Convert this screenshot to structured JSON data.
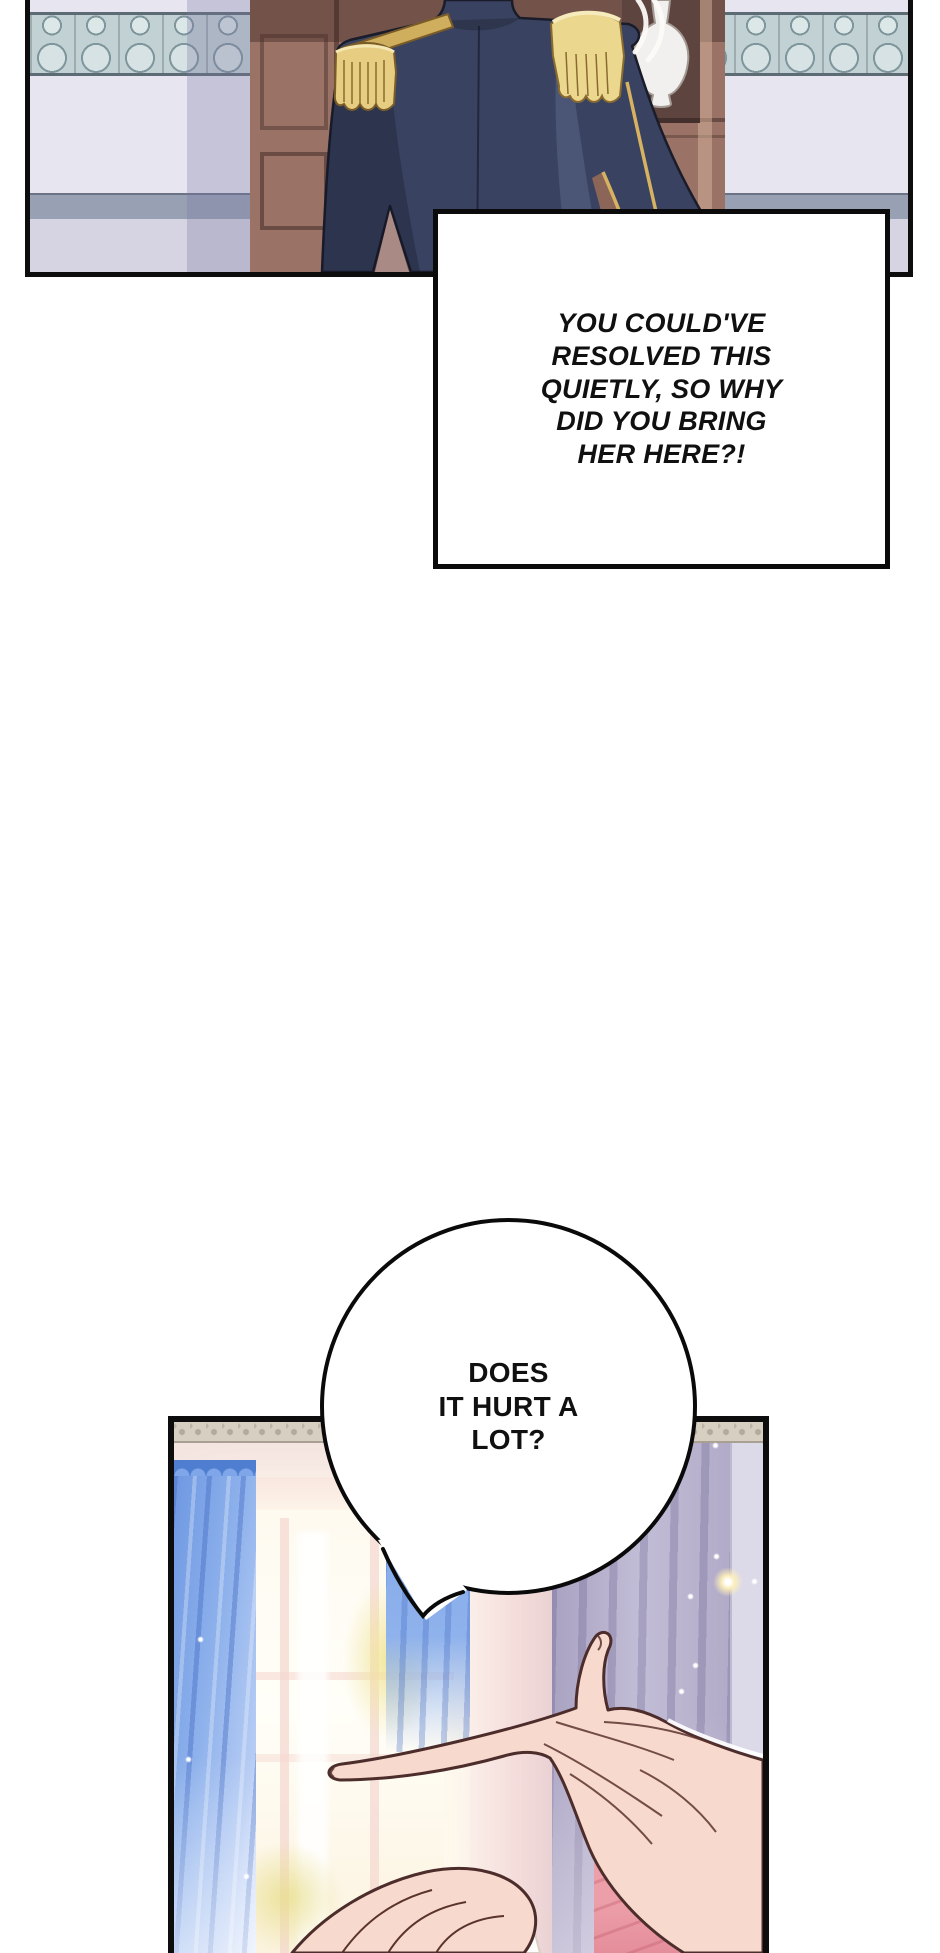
{
  "meta": {
    "kind": "webtoon comic page",
    "canvas": {
      "width": 940,
      "height": 1953,
      "background": "#ffffff"
    }
  },
  "bubbles": {
    "shout": {
      "shape": "rectangle",
      "text": "YOU COULD'VE\nRESOLVED THIS\nQUIETLY, SO WHY\nDID YOU BRING\nHER HERE?!"
    },
    "ask": {
      "shape": "circle-with-tail",
      "text": "DOES\nIT HURT A\nLOT?"
    }
  },
  "panels": {
    "top": {
      "description": "Back view of a man in a navy dress uniform with gold fringed epaulettes standing before a brown wooden cabinet; pale wall with carved blue-green frieze band and grey chair rail; white vase in a dark alcove.",
      "palette": {
        "wall": "#e7e5ef",
        "frieze": "#c2d1d4",
        "chair_rail": "#98a1b4",
        "wall_lower": "#d6d4e2",
        "cabinet": "#9a7366",
        "cabinet_dark": "#6e4f49",
        "uniform_navy": "#394260",
        "uniform_shadow": "#2b3149",
        "epaulette_gold": "#e6cd82",
        "piping_gold": "#d7b261",
        "vase": "#f2f0ee",
        "alcove": "#5e443f",
        "border": "#0d0d0d"
      }
    },
    "bottom": {
      "description": "Sunlit room: bright window with blue curtains on the left, lavender drapes and golden sparkles on the right; one hand gently holding another person's hand; pink cushion at lower right.",
      "palette": {
        "wall": "#f6ebe7",
        "curtain_blue": "#7ea6e8",
        "curtain_lavender": "#bcb6cf",
        "window_light": "#fffdf4",
        "foliage": "#efe3a9",
        "skin": "#f8d9cd",
        "skin_outline": "#4d2d2b",
        "cushion": "#ec9fa9",
        "sparkle": "#fff6d8",
        "border": "#0d0d0d"
      }
    }
  }
}
